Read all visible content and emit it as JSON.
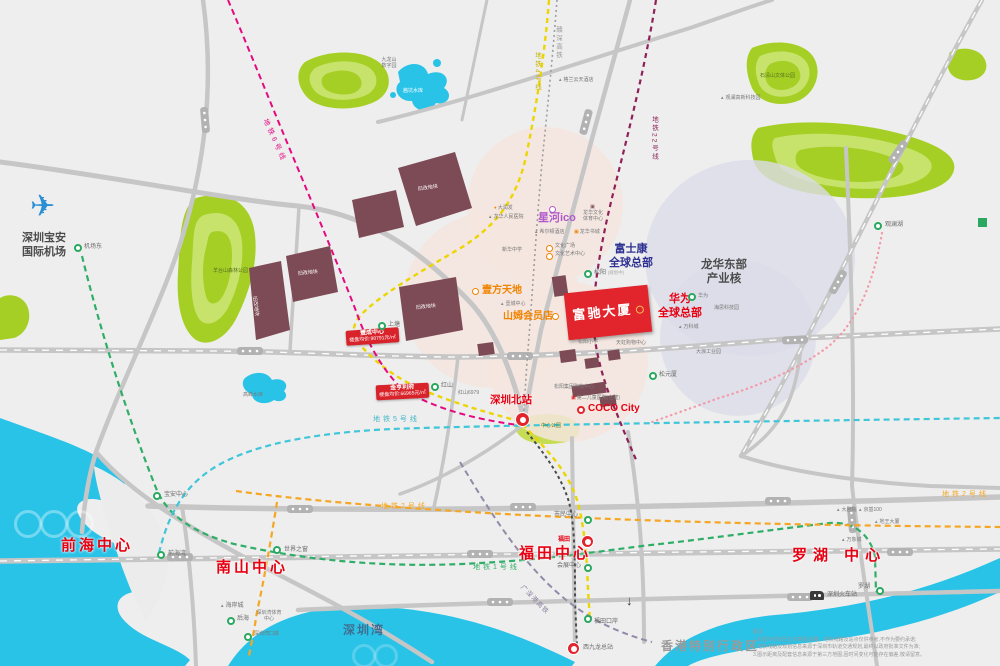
{
  "regions": {
    "qianhai": "前海中心",
    "nanshan": "南山中心",
    "futian": "福田中心",
    "luohu": "罗湖 中心"
  },
  "areas": {
    "shenzhenwan": "深圳湾",
    "hongkong": "香港特别行政区",
    "airport_l1": "深圳宝安",
    "airport_l2": "国际机场",
    "foxconn_l1": "富士康",
    "foxconn_l2": "全球总部",
    "huawei_l1": "华为",
    "huawei_l2": "全球总部",
    "longhua_l1": "龙华东部",
    "longhua_l2": "产业核"
  },
  "property": {
    "name": "富驰大厦"
  },
  "price_cards": [
    {
      "title": "壹成中心",
      "price": "楼盘均价:98791元/㎡"
    },
    {
      "title": "金亨利府",
      "price": "楼盘均价:66965元/㎡"
    }
  ],
  "brand_pois": {
    "xinghe": "星河ico",
    "yifang": "壹方天地",
    "sams": "山姆会员店",
    "coco": "COCO City",
    "szbei": "深圳北站",
    "szrail": "深圳火车站",
    "xjl": "西九龙总站"
  },
  "stations": {
    "jichangdong": "机场东",
    "songyang": "松阳",
    "songyang_note": "(规划中)",
    "shangtang": "上塘",
    "hongshan": "红山",
    "songyuanxia": "松元厦",
    "guanlanhu": "观澜湖",
    "huawei_st": "华为",
    "baoanzx": "宝安中心",
    "qianhaiwan": "前海湾",
    "window": "世界之窗",
    "haianchen": "海岸城",
    "houhai": "后海",
    "szw_sports": "深圳湾体育中心",
    "szw_port": "深圳湾口岸",
    "shimin": "市民中心",
    "futian_st": "福田",
    "huizhan": "会展中心",
    "ftka": "福田口岸",
    "luohu_st": "罗湖"
  },
  "pois": {
    "yangtaishan": "羊台山森林公园",
    "qiankeng": "茜坑水库",
    "jiulongshan_l1": "九龙山",
    "jiulongshan_l2": "数字园",
    "gaofeng": "高峰水库",
    "shiqing": "石清山文体公园",
    "guanlan_tech": "观澜高新科技园",
    "gelan": "格兰云天酒店",
    "darunfa": "大润发",
    "renmin": "龙华人民医院",
    "xierdun": "希尔顿酒店",
    "shucheng": "龙华书城",
    "whgc": "文化广场",
    "whys": "文化艺术中心",
    "lhwt_l1": "龙华文化",
    "lhwt_l2": "体育中心",
    "xinhua": "新华中学",
    "yicheng": "壹城中心",
    "sy_school": "松阳小学",
    "tianhong": "天虹购物中心",
    "jituan": "松阳集团购物中心",
    "children": "第二儿童医院(在建)",
    "haisi": "海思科技园",
    "wanke": "万科城",
    "dalang": "大浪工业园",
    "zhongxin": "中心公园",
    "hs6979": "红山6979",
    "dajuyuan": "大剧院",
    "jingji": "京基100",
    "diwang": "地王大厦",
    "wanxiang": "万象城"
  },
  "renewal": {
    "label": "旧改地块"
  },
  "lines": {
    "l1": "地铁1号线",
    "l2": "地铁2号线",
    "l4": "地铁4号线",
    "l5": "地铁5号线",
    "l6": "地铁6号线",
    "l22": "地铁22号线",
    "ganshen": "赣深高铁",
    "gsg": "广深港高铁"
  },
  "notes": {
    "title": "备注:",
    "line1": "1.本图为项目区位示意图,道路、地铁线路及站点仅供参考,不作为要约承诺;",
    "line2": "2.地铁线路及规划信息来源于深圳市轨道交通规划,最终以政府批准文件为准;",
    "line3": "3.图示距离及配套信息来源于第三方地图,因时间变化可能存在偏差,敬请留意。"
  },
  "colors": {
    "accent_red": "#e2242c",
    "water": "#29c3e8",
    "park": "#a5cf25"
  }
}
